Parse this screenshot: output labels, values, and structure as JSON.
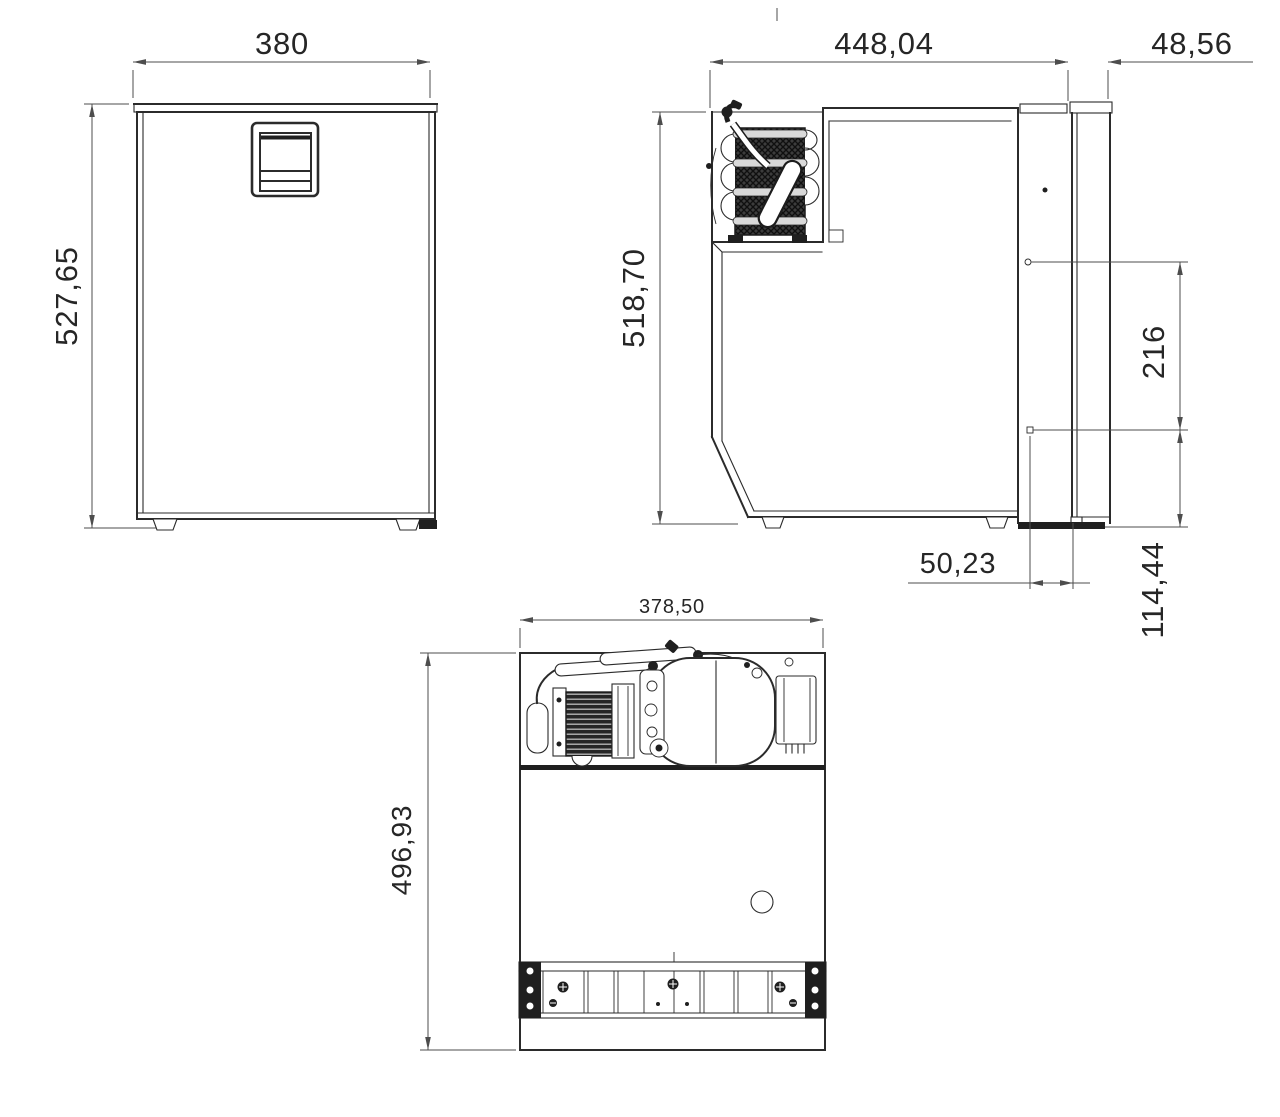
{
  "front": {
    "width": "380",
    "height": "527,65"
  },
  "side": {
    "depth": "448,04",
    "door_thickness": "48,56",
    "height": "518,70",
    "upper_offset": "216",
    "recess_depth": "50,23",
    "base_height": "114,44"
  },
  "plan": {
    "width": "378,50",
    "depth": "496,93"
  },
  "colors": {
    "background": "#ffffff",
    "outline": "#2b2b2b",
    "dimension_line": "#4d4d4d",
    "dark_fill": "#1f1f1f"
  },
  "views": {
    "front_label": "front-view",
    "side_label": "side-view",
    "plan_label": "bottom-plan-view"
  }
}
